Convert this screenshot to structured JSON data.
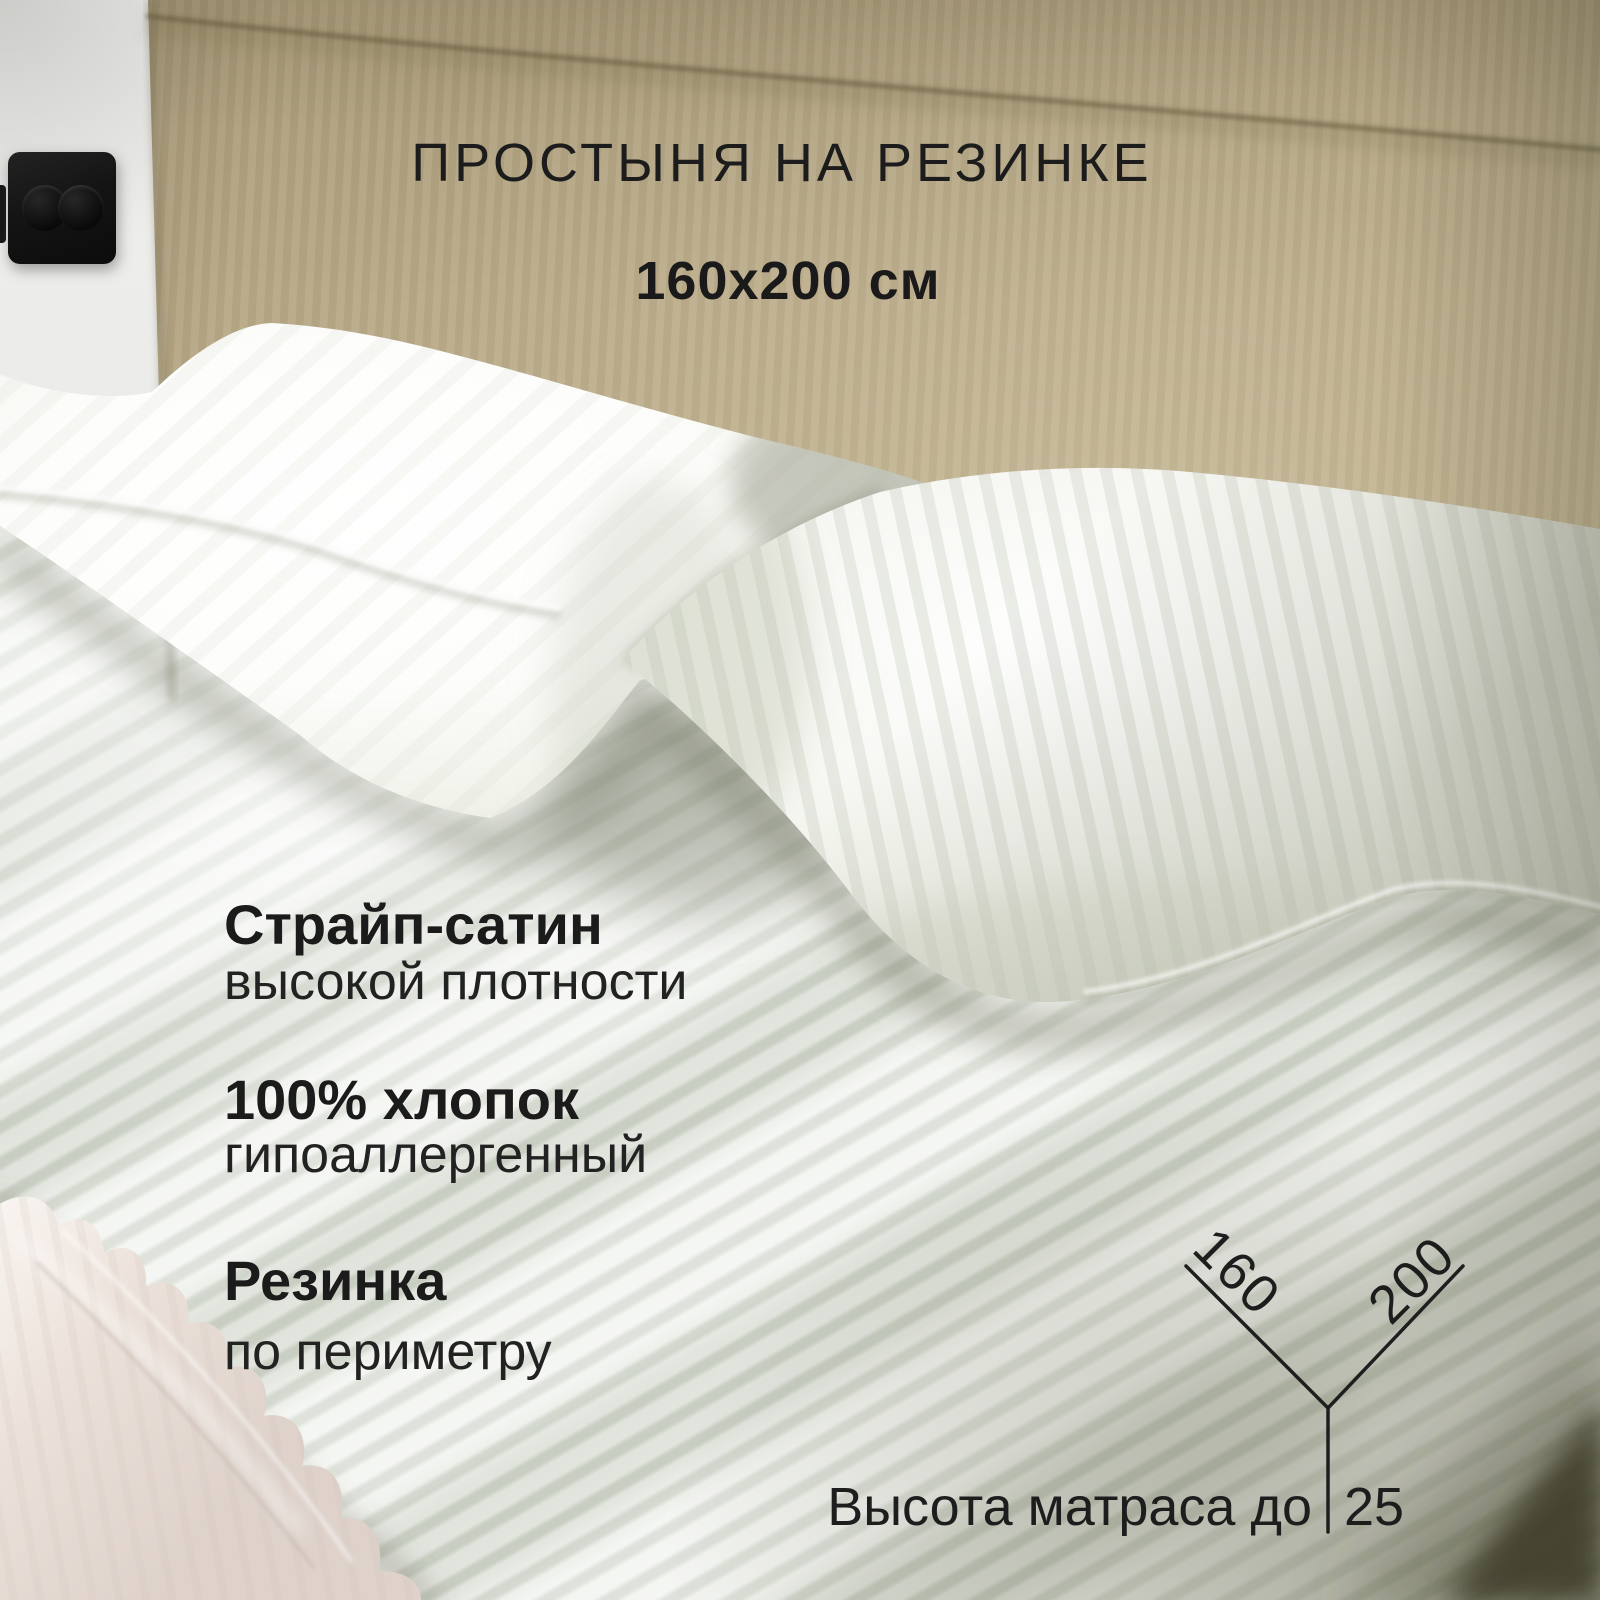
{
  "page": {
    "type": "product-card-infographic",
    "language": "ru"
  },
  "header": {
    "title": "ПРОСТЫНЯ НА РЕЗИНКЕ",
    "size_label": "160x200 см"
  },
  "features": [
    {
      "title": "Страйп-сатин",
      "subtitle": "высокой плотности"
    },
    {
      "title": "100% хлопок",
      "subtitle": "гипоаллергенный"
    },
    {
      "title": "Резинка",
      "subtitle": "по периметру"
    }
  ],
  "dimension_diagram": {
    "width_label": "160",
    "length_label": "200",
    "height_caption": "Высота матраса до",
    "height_value": "25"
  },
  "scene": {
    "objects": [
      "bedroom-wall",
      "power-outlet",
      "bed-headboard",
      "pillow-left",
      "pillow-right",
      "fitted-sheet-mattress",
      "sheet-elastic-ruffle"
    ],
    "colors": {
      "wall": "#e8e9e6",
      "headboard_beige": "#b7a886",
      "sheet_sage_white": "#e3e7df",
      "pillow_white": "#ffffff",
      "text_dark": "#1d1d1d",
      "shadow_olive": "#6c7058",
      "ruffle_cream": "#ece2db",
      "corner_dark": "#403d29"
    }
  }
}
